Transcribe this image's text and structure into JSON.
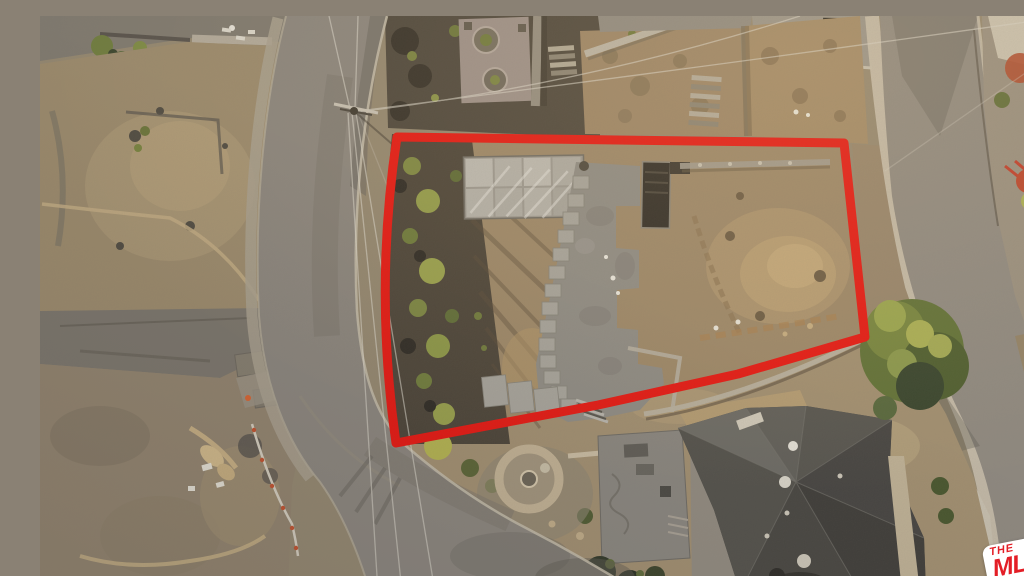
{
  "meta": {
    "description": "Aerial drone photo of a cleared hillside lot outlined in red, bordered by curving streets, burned neighboring lots to the west, a large gray hip-roof house to the southeast, and a round stone patio below the lot."
  },
  "overlay": {
    "boundary_color": "#e9140e"
  },
  "watermark": {
    "brand_top": "THE",
    "brand_main": "MLS",
    "brand_tm": "™",
    "brand_suffix": ".COM",
    "text_color": "#e31e26",
    "background_color": "#ffffff"
  },
  "palette": {
    "road": "#8b857d",
    "dirt": "#9d8767",
    "concrete_slab": "#8e8b84",
    "roof_dark": "#454340",
    "olive_vegetation": "#7e8840",
    "burned_ground": "#4a4236",
    "sidewalk": "#c6bdab"
  }
}
